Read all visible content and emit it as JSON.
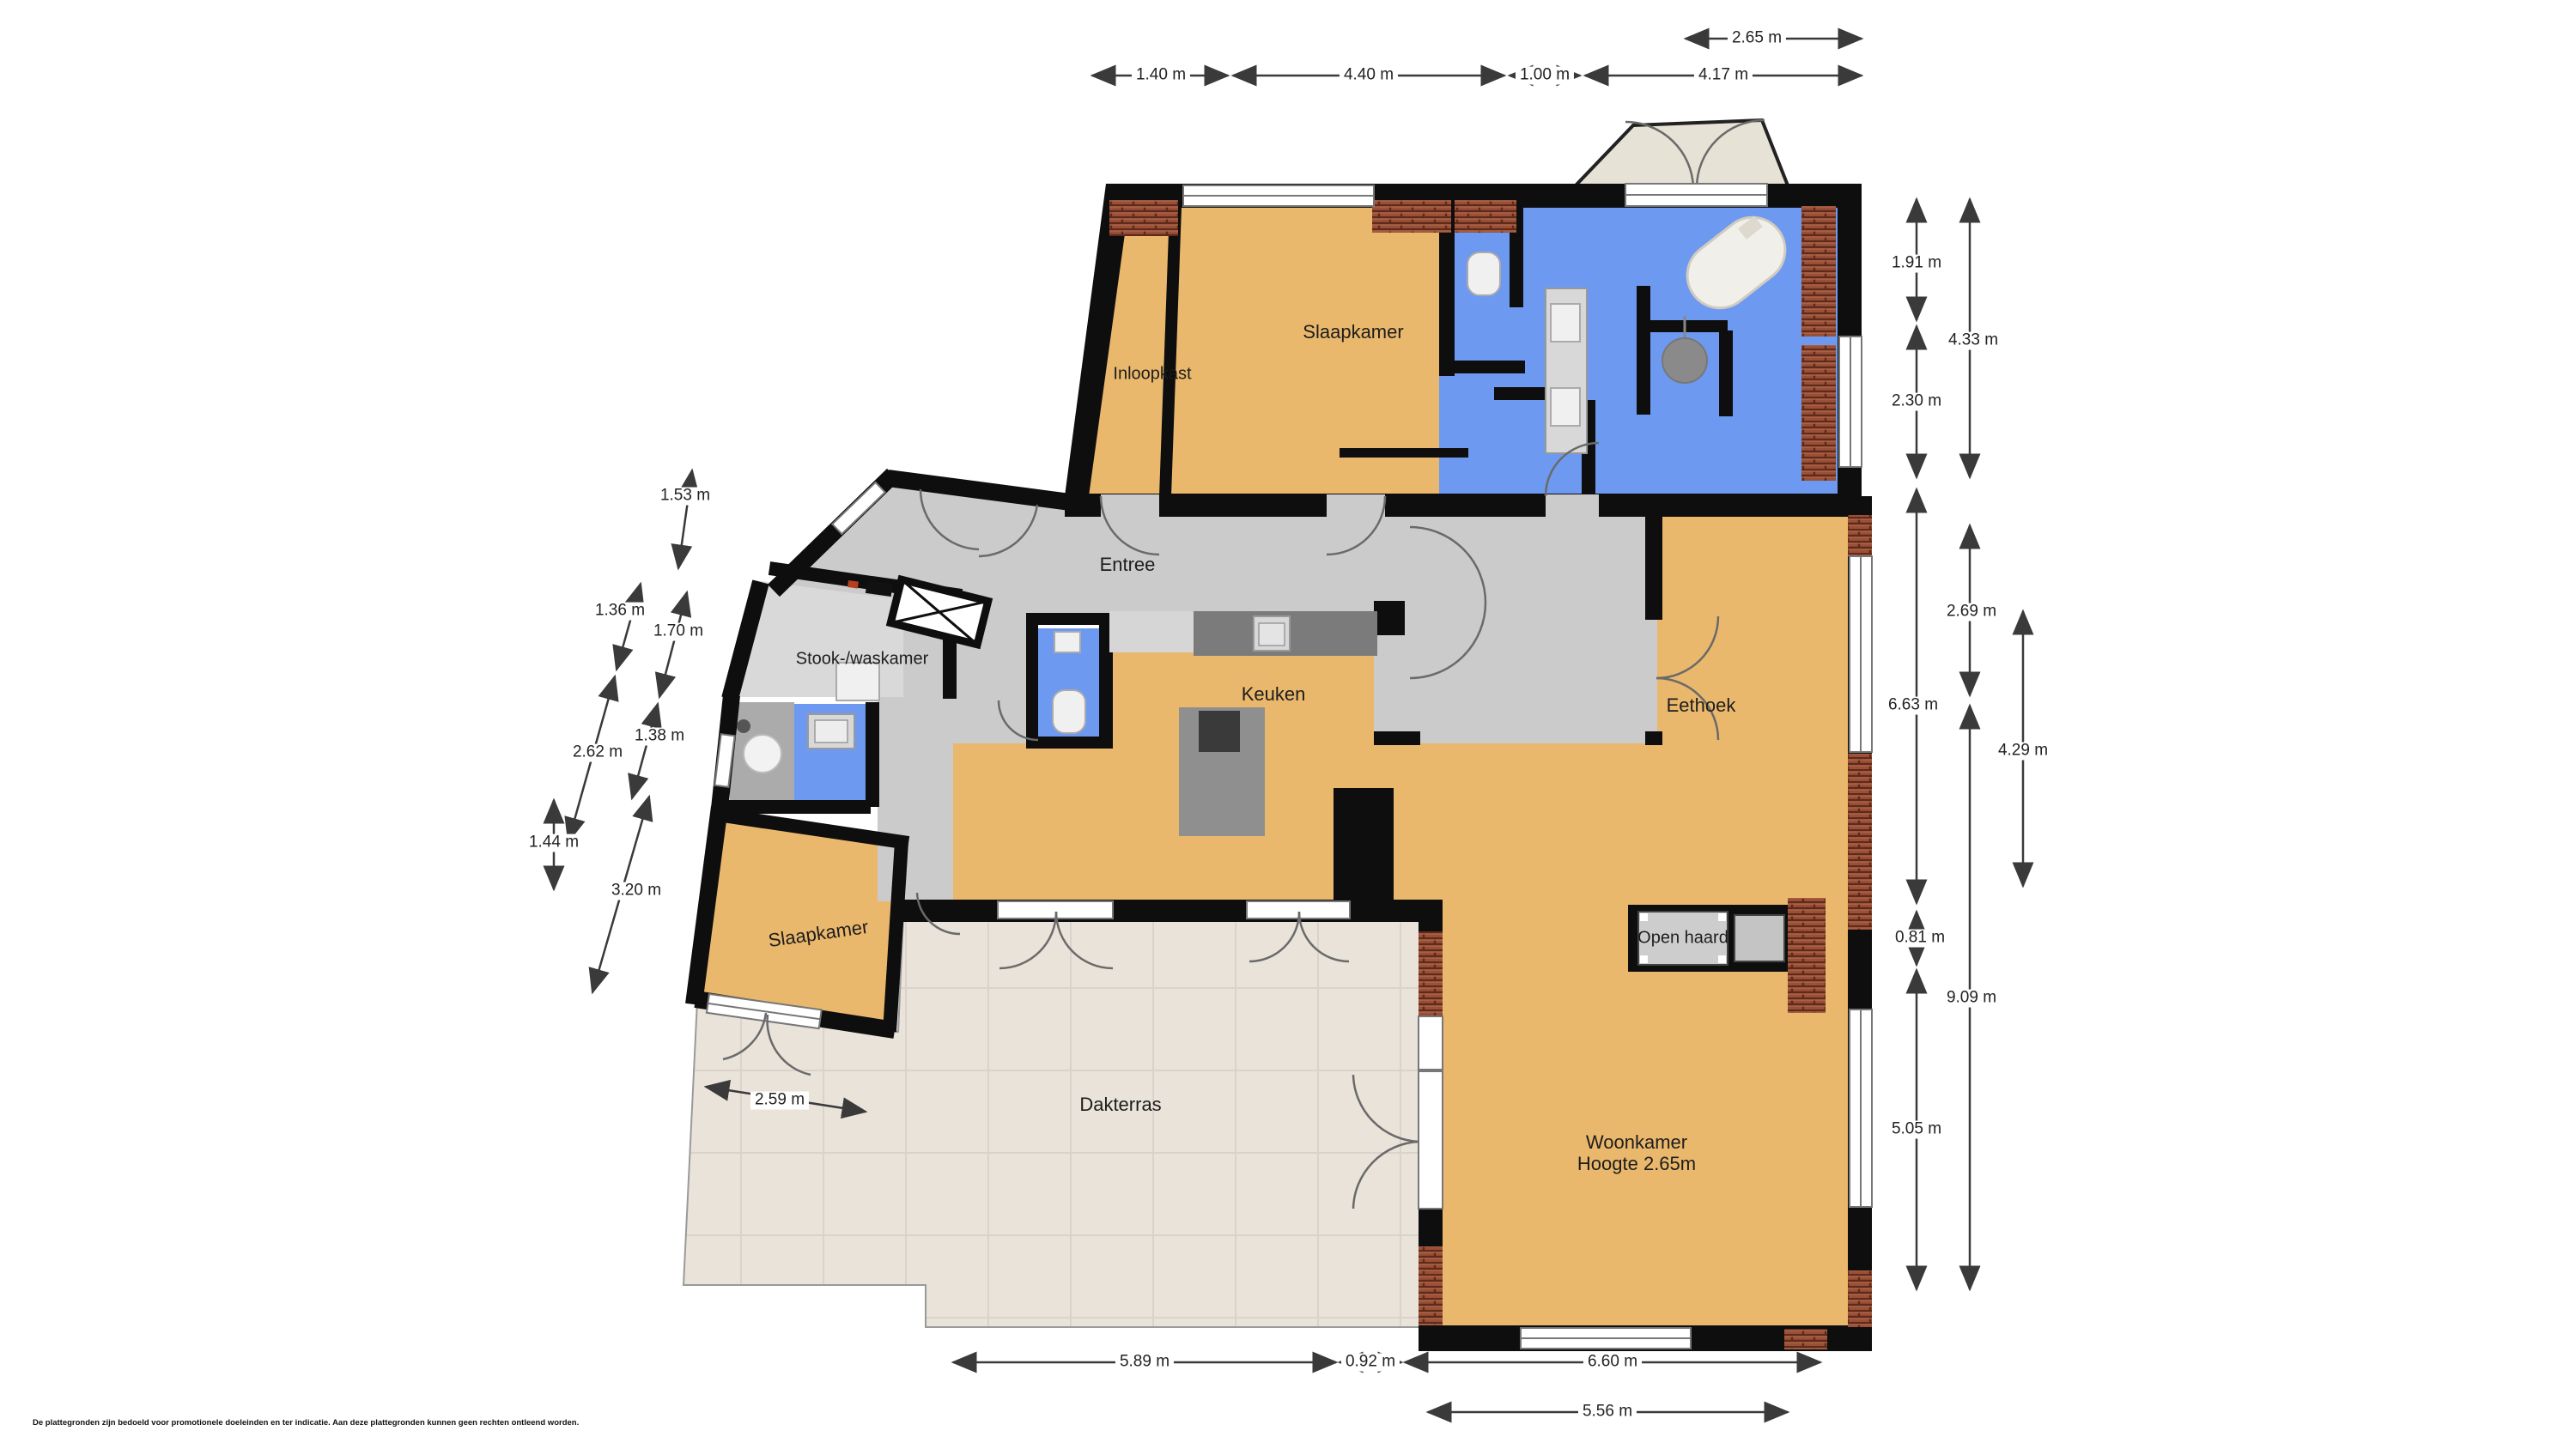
{
  "colors": {
    "floor_tan": "#EAB86C",
    "water_blue": "#6D9AF0",
    "hall_gray": "#CBCBCB",
    "stook_gray": "#D9D9D9",
    "terrace_beige": "#E9E3DA",
    "wall_black": "#0E0E0E",
    "brick_red": "#9B4F36"
  },
  "rooms": {
    "slaapkamer_top": {
      "label": "Slaapkamer"
    },
    "inloopkast": {
      "label": "Inloopkast"
    },
    "entree": {
      "label": "Entree"
    },
    "stook_waskamer": {
      "label": "Stook-/waskamer"
    },
    "keuken": {
      "label": "Keuken"
    },
    "eethoek": {
      "label": "Eethoek"
    },
    "slaapkamer_onder": {
      "label": "Slaapkamer"
    },
    "open_haard": {
      "label": "Open haard"
    },
    "dakterras": {
      "label": "Dakterras"
    },
    "woonkamer": {
      "label": "Woonkamer",
      "height_note": "Hoogte 2.65m"
    }
  },
  "dims": {
    "top_265": "2.65 m",
    "top_140": "1.40 m",
    "top_440": "4.40 m",
    "top_100": "1.00 m",
    "top_417": "4.17 m",
    "left_153": "1.53 m",
    "left_136": "1.36 m",
    "left_170": "1.70 m",
    "left_262": "2.62 m",
    "left_138": "1.38 m",
    "left_144": "1.44 m",
    "left_320": "3.20 m",
    "left_259": "2.59 m",
    "right_191": "1.91 m",
    "right_433": "4.33 m",
    "right_230": "2.30 m",
    "right_269": "2.69 m",
    "right_663": "6.63 m",
    "right_429": "4.29 m",
    "right_081": "0.81 m",
    "right_909": "9.09 m",
    "right_505": "5.05 m",
    "bottom_589": "5.89 m",
    "bottom_092": "0.92 m",
    "bottom_660": "6.60 m",
    "bottom_556": "5.56 m"
  },
  "footer": {
    "disclaimer": "De plattegronden zijn bedoeld voor promotionele doeleinden en ter indicatie. Aan deze plattegronden kunnen geen rechten ontleend worden."
  }
}
